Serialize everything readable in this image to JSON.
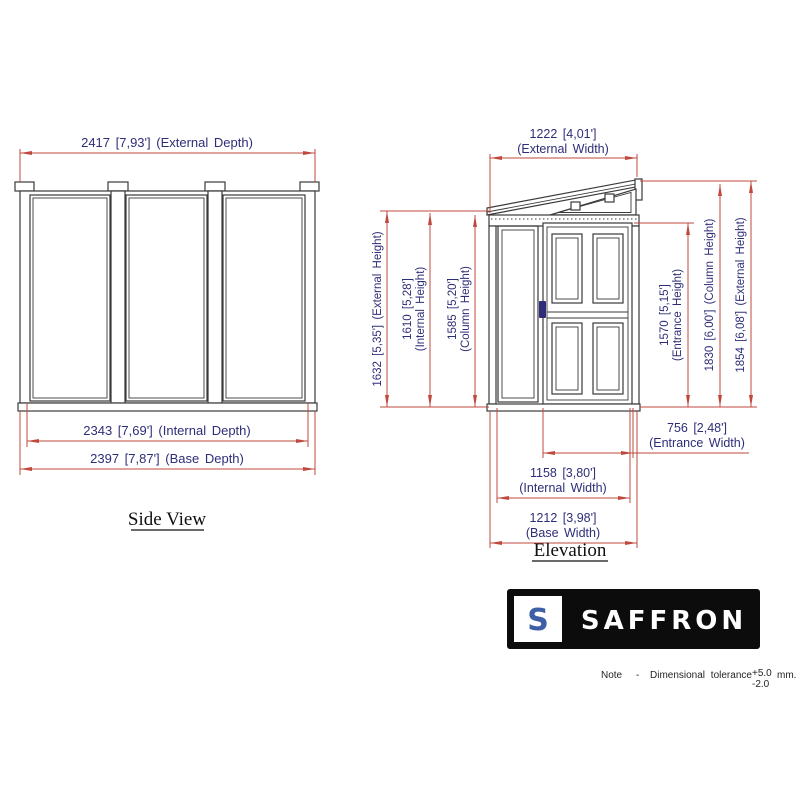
{
  "side_view": {
    "caption": "Side View",
    "dims": {
      "external_depth": "2417 [7,93'] (External Depth)",
      "internal_depth": "2343 [7,69'] (Internal Depth)",
      "base_depth": "2397 [7,87'] (Base Depth)"
    }
  },
  "elevation": {
    "caption": "Elevation",
    "dims": {
      "external_width": {
        "value": "1222 [4,01']",
        "label": "(External Width)"
      },
      "external_height_left": {
        "text": "1632 [5,35'] (External Height)"
      },
      "internal_height": {
        "value": "1610 [5,28']",
        "label": "(Internal Height)"
      },
      "column_height_left": {
        "value": "1585 [5,20']",
        "label": "(Column Height)"
      },
      "entrance_height": {
        "value": "1570 [5,15']",
        "label": "(Entrance Height)"
      },
      "column_height_right": {
        "text": "1830 [6,00'] (Column Height)"
      },
      "external_height_right": {
        "text": "1854 [6,08'] (External Height)"
      },
      "entrance_width": {
        "value": "756 [2,48']",
        "label": "(Entrance Width)"
      },
      "internal_width": {
        "value": "1158 [3,80']",
        "label": "(Internal Width)"
      },
      "base_width": {
        "value": "1212 [3,98']",
        "label": "(Base Width)"
      }
    }
  },
  "logo": {
    "monogram": "S",
    "brand": "SAFFRON"
  },
  "note": {
    "label": "Note",
    "dash": "-",
    "text": "Dimensional tolerance",
    "tolerance_plus": "+5.0",
    "tolerance_minus": "-2.0",
    "unit": "mm."
  },
  "colors": {
    "dimension_line": "#c0493f",
    "dimension_text": "#2e2e78",
    "drawing_line": "#3a3a3a",
    "logo_background": "#0c0c0c",
    "logo_monogram_blue": "#3d5fa6",
    "door_handle_blue": "#2e2e78"
  }
}
